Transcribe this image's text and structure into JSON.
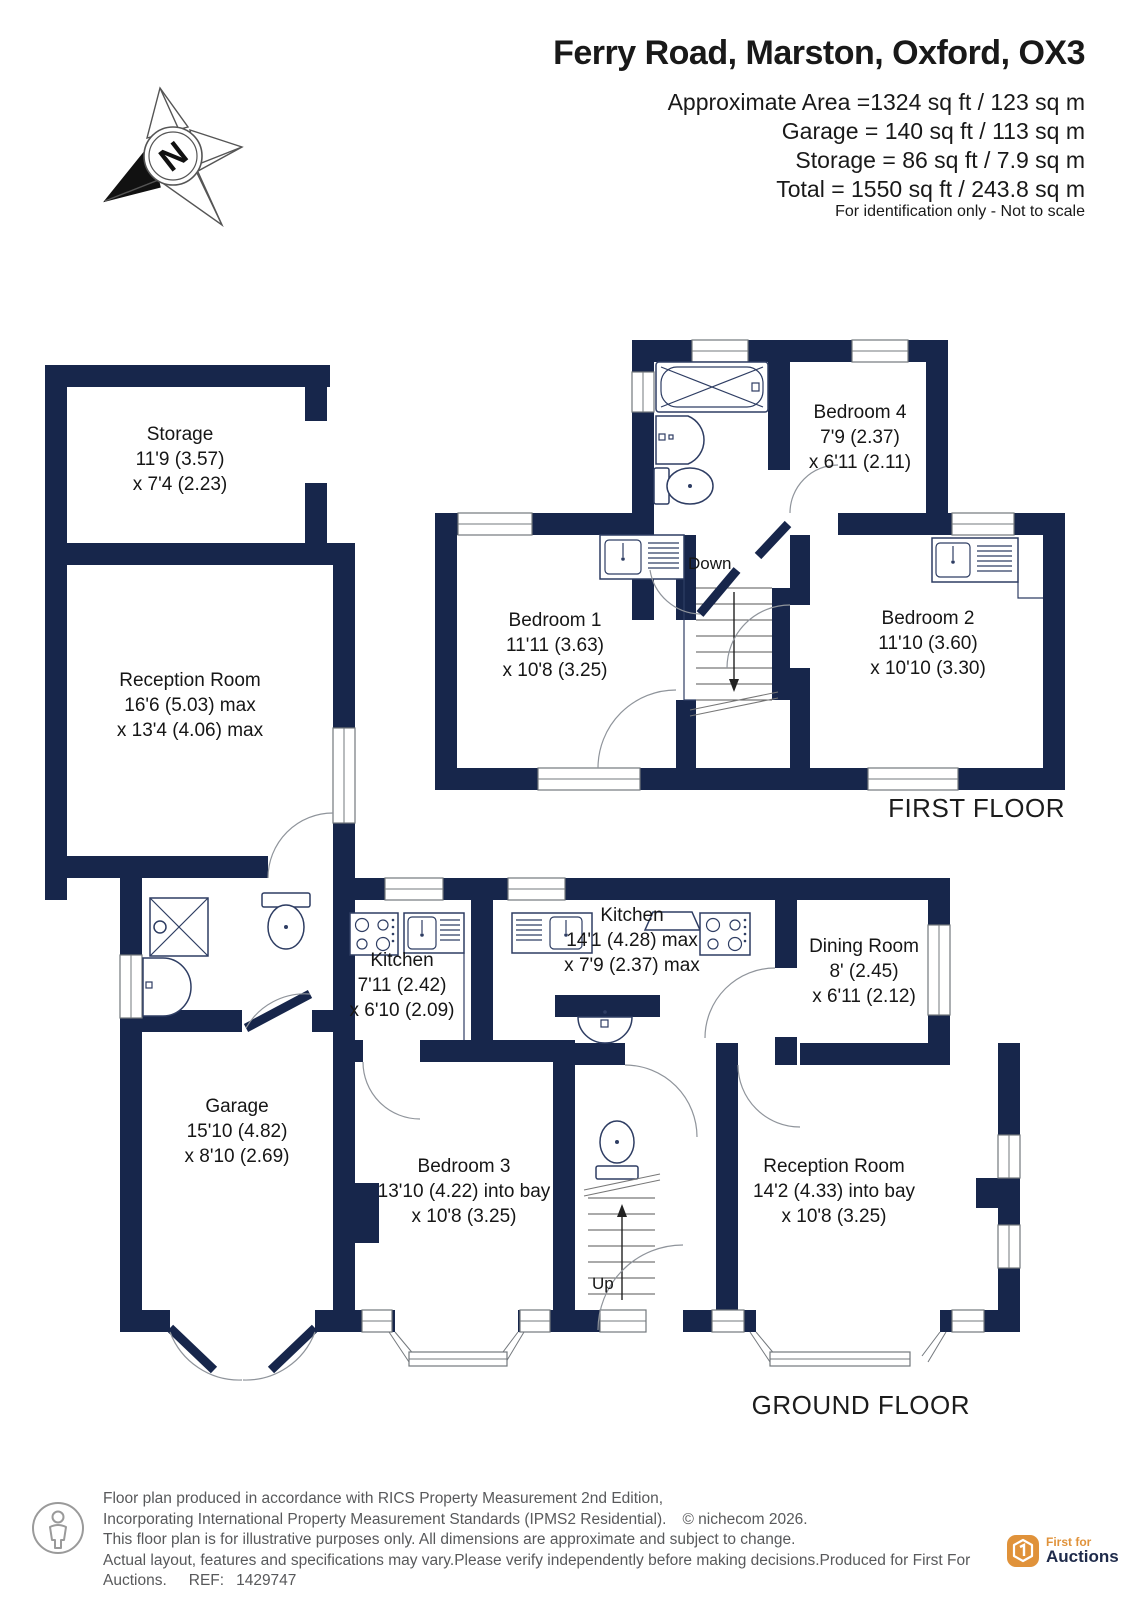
{
  "header": {
    "title": "Ferry Road, Marston, Oxford, OX3",
    "area_lines": [
      "Approximate Area =1324 sq ft / 123 sq m",
      "Garage = 140 sq ft / 113 sq m",
      "Storage = 86 sq ft / 7.9 sq m",
      "Total = 1550 sq ft / 243.8 sq m"
    ],
    "note": "For identification only - Not to scale",
    "compass_letter": "N"
  },
  "floors": {
    "first": {
      "caption": "FIRST FLOOR",
      "stairs_label": "Down",
      "rooms": [
        {
          "name": "Bedroom 4",
          "line2": "7'9 (2.37)",
          "line3": "x 6'11 (2.11)"
        },
        {
          "name": "Bedroom 1",
          "line2": "11'11 (3.63)",
          "line3": "x 10'8 (3.25)"
        },
        {
          "name": "Bedroom 2",
          "line2": "11'10 (3.60)",
          "line3": "x 10'10 (3.30)"
        }
      ]
    },
    "ground": {
      "caption": "GROUND FLOOR",
      "stairs_label": "Up",
      "rooms": [
        {
          "name": "Storage",
          "line2": "11'9 (3.57)",
          "line3": "x 7'4 (2.23)"
        },
        {
          "name": "Reception Room",
          "line2": "16'6 (5.03) max",
          "line3": "x 13'4 (4.06) max"
        },
        {
          "name": "Kitchen",
          "line2": "7'11 (2.42)",
          "line3": "x 6'10 (2.09)"
        },
        {
          "name": "Kitchen",
          "line2": "14'1 (4.28) max",
          "line3": "x 7'9 (2.37) max"
        },
        {
          "name": "Dining Room",
          "line2": "8' (2.45)",
          "line3": "x 6'11 (2.12)"
        },
        {
          "name": "Garage",
          "line2": "15'10 (4.82)",
          "line3": "x 8'10 (2.69)"
        },
        {
          "name": "Bedroom 3",
          "line2": "13'10 (4.22) into bay",
          "line3": "x 10'8 (3.25)"
        },
        {
          "name": "Reception Room",
          "line2": "14'2 (4.33) into bay",
          "line3": "x 10'8 (3.25)"
        }
      ]
    }
  },
  "footer": {
    "line1": "Floor plan produced in accordance with RICS Property Measurement 2nd Edition,",
    "line2": "Incorporating International Property Measurement Standards (IPMS2 Residential).",
    "copyright": "© nichecom 2026.",
    "line3": "This floor plan is for illustrative purposes only. All dimensions are approximate and subject to change.",
    "line4": "Actual layout, features and specifications may vary.Please verify independently before making decisions.Produced for First For Auctions.",
    "ref_label": "REF:",
    "ref_value": "1429747",
    "logo_top": "First for",
    "logo_bottom": "Auctions"
  },
  "colors": {
    "wall": "#17264b",
    "logo_orange": "#e0923a",
    "logo_navy": "#1e2a4a",
    "footer_gray": "#58595b"
  }
}
